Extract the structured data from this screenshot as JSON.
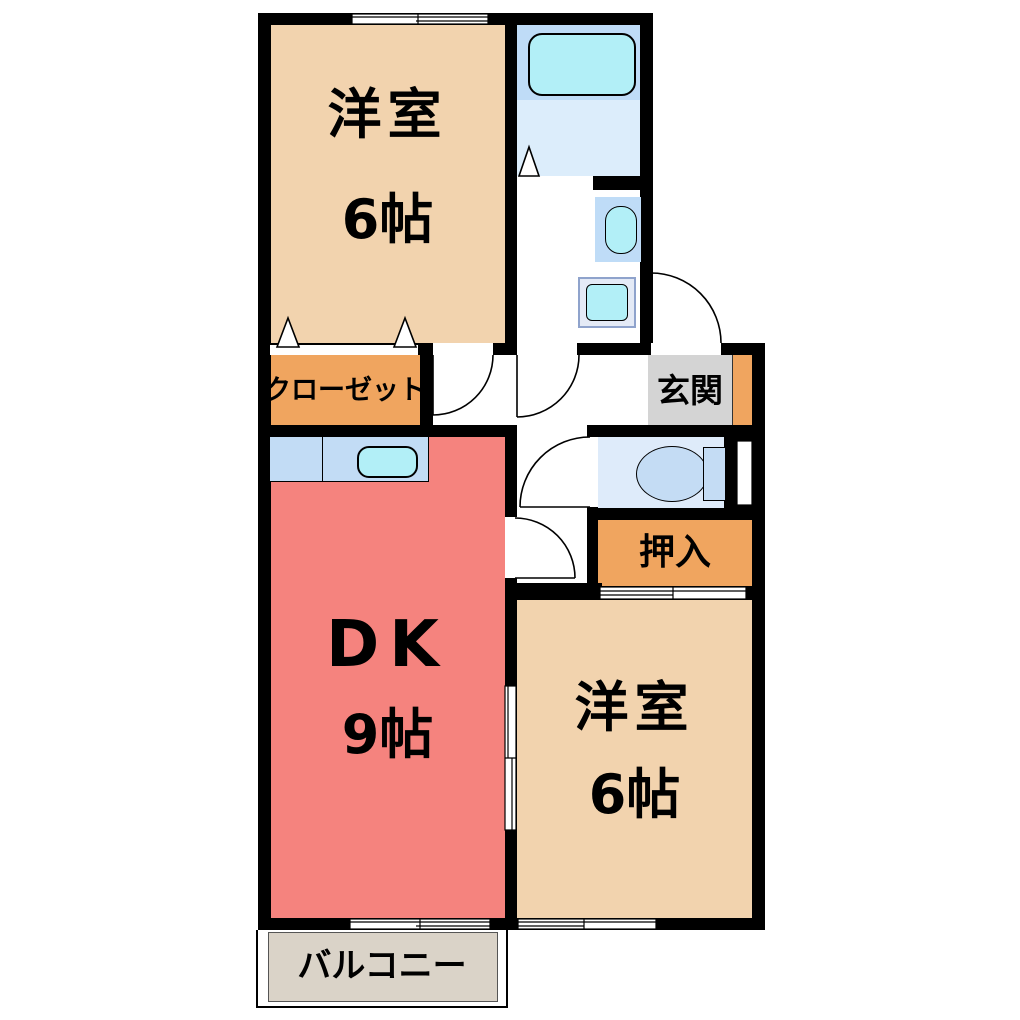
{
  "plan_title": "2DK floor plan",
  "rooms": {
    "western_top": {
      "name": "洋室",
      "size": "6帖"
    },
    "dk": {
      "name": "DK",
      "size": "9帖"
    },
    "western_bottom": {
      "name": "洋室",
      "size": "6帖"
    },
    "closet": {
      "name": "クローゼット"
    },
    "entrance": {
      "name": "玄関"
    },
    "oshiire": {
      "name": "押入"
    },
    "balcony": {
      "name": "バルコニー"
    }
  },
  "fixtures": {
    "bathtub": "bathtub",
    "bath_room": "unit-bath",
    "washbasin": "washbasin",
    "washing_machine": "washing-machine-pan",
    "kitchen_counter": "kitchen-counter",
    "kitchen_sink": "kitchen-sink",
    "toilet": "toilet"
  },
  "colors": {
    "wall": "#000000",
    "room_beige": "#F2D3AE",
    "dk_salmon": "#F5837E",
    "label_orange": "#F0A55F",
    "genkan_gray": "#D4D4D4",
    "balcony_gray": "#DAD3C8",
    "water_blue": "#BFDCF7",
    "water_pale": "#DCEDFB",
    "fixture_cyan": "#B2EFF7",
    "toilet_blue": "#DEEBFA",
    "fixture_blue": "#C4DCF4",
    "counter_blue": "#C2DCF5"
  }
}
